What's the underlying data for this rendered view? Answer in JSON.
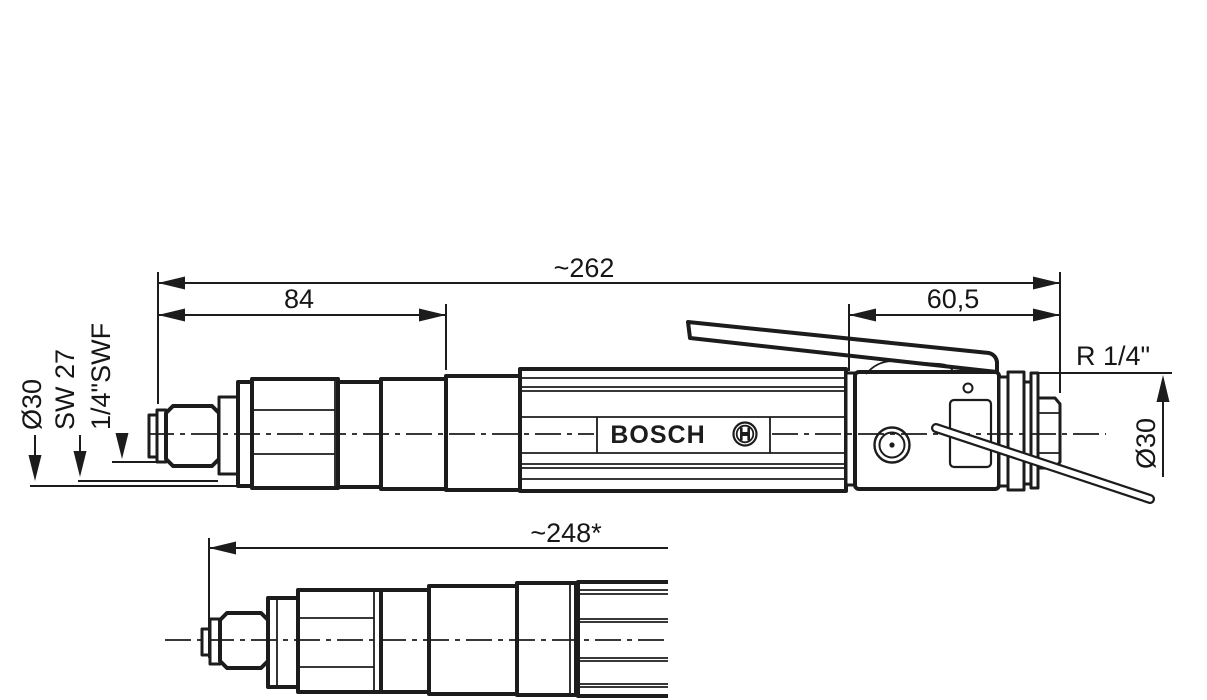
{
  "drawing": {
    "brand": "BOSCH",
    "dimensions": {
      "overall_length": "~262",
      "front_section_length": "84",
      "rear_section_length": "60,5",
      "variant_length": "~248*",
      "air_inlet_thread": "R 1/4\"",
      "body_diameter_rear": "Ø30",
      "body_diameter_front": "Ø30",
      "wrench_flat": "SW 27",
      "spindle_drive": "1/4\"SWF"
    },
    "colors": {
      "line": "#1c1c1c",
      "background": "#ffffff"
    }
  }
}
